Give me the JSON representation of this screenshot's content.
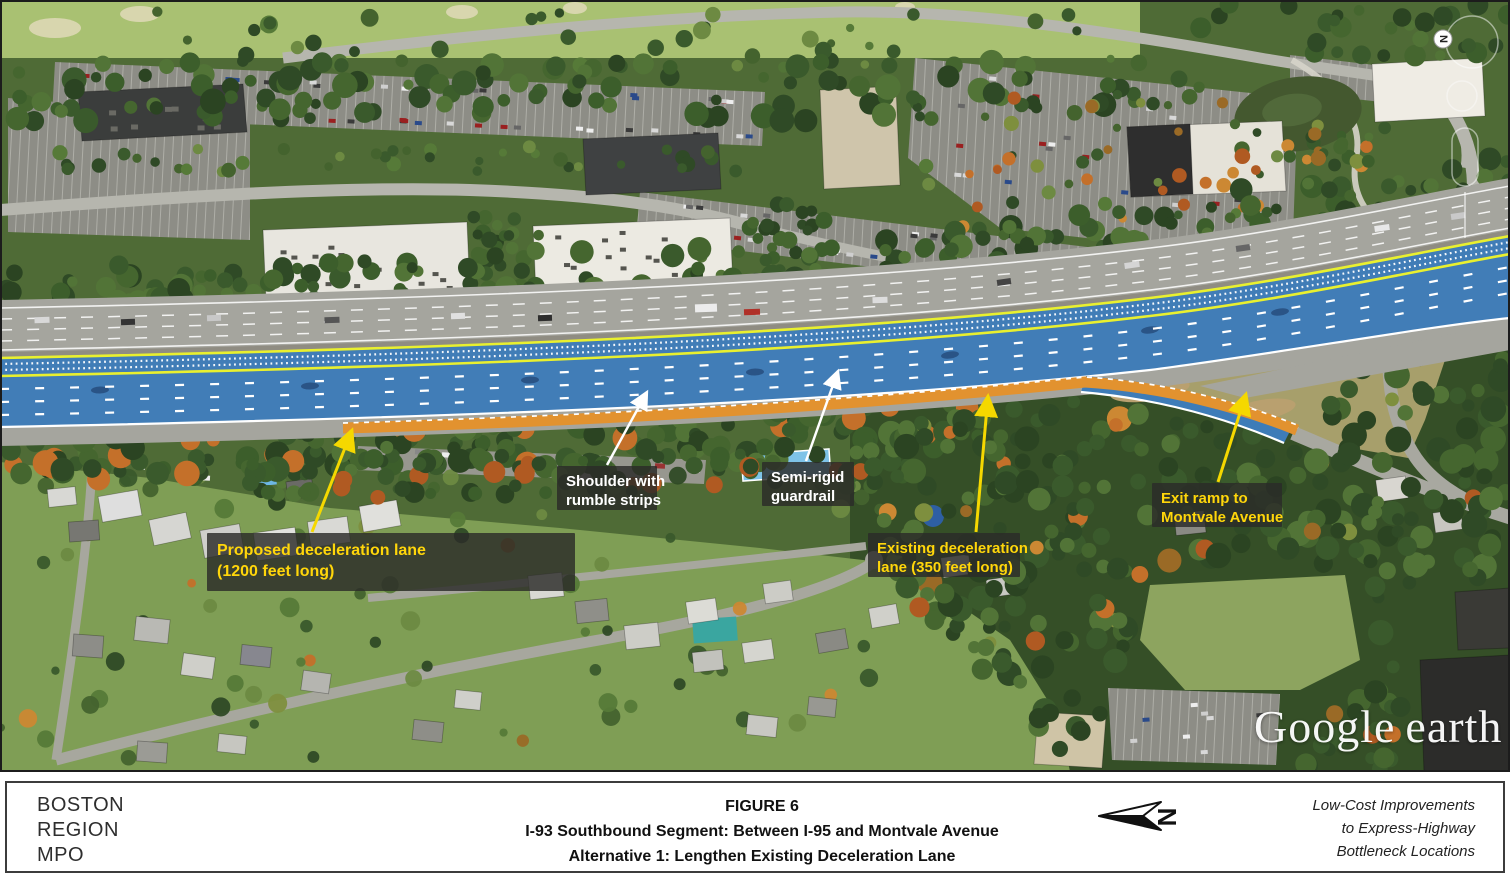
{
  "map": {
    "callouts": [
      {
        "id": "proposed",
        "lines": [
          "Proposed deceleration lane",
          "(1200 feet long)"
        ],
        "text_color": "#FFD60A"
      },
      {
        "id": "shoulder",
        "lines": [
          "Shoulder with",
          "rumble strips"
        ],
        "text_color": "#FFFFFF"
      },
      {
        "id": "semirigid",
        "lines": [
          "Semi-rigid",
          "guardrail"
        ],
        "text_color": "#FFFFFF"
      },
      {
        "id": "existing",
        "lines": [
          "Existing deceleration",
          "lane (350 feet long)"
        ],
        "text_color": "#FFD60A"
      },
      {
        "id": "exitramp",
        "lines": [
          "Exit ramp to",
          "Montvale Avenue"
        ],
        "text_color": "#FFD60A"
      }
    ],
    "watermark": {
      "word1": "Google",
      "word2": "earth"
    },
    "compass_letter": "N"
  },
  "footer": {
    "agency_lines": [
      "BOSTON",
      "REGION",
      "MPO"
    ],
    "figure_label": "FIGURE 6",
    "title_line1": "I-93 Southbound Segment: Between I-95 and Montvale Avenue",
    "title_line2": "Alternative 1: Lengthen Existing Deceleration Lane",
    "north_letter": "N",
    "project_lines": [
      "Low-Cost Improvements",
      "to Express-Highway",
      "Bottleneck Locations"
    ]
  },
  "colors": {
    "overlay_blue": "#3E7CB8",
    "proposed_lane_orange": "#E2922F",
    "edge_line_yellow": "#E9F02F",
    "callout_text_yellow": "#FFD60A",
    "callout_text_white": "#FFFFFF",
    "callout_background": "#2B2B28"
  }
}
